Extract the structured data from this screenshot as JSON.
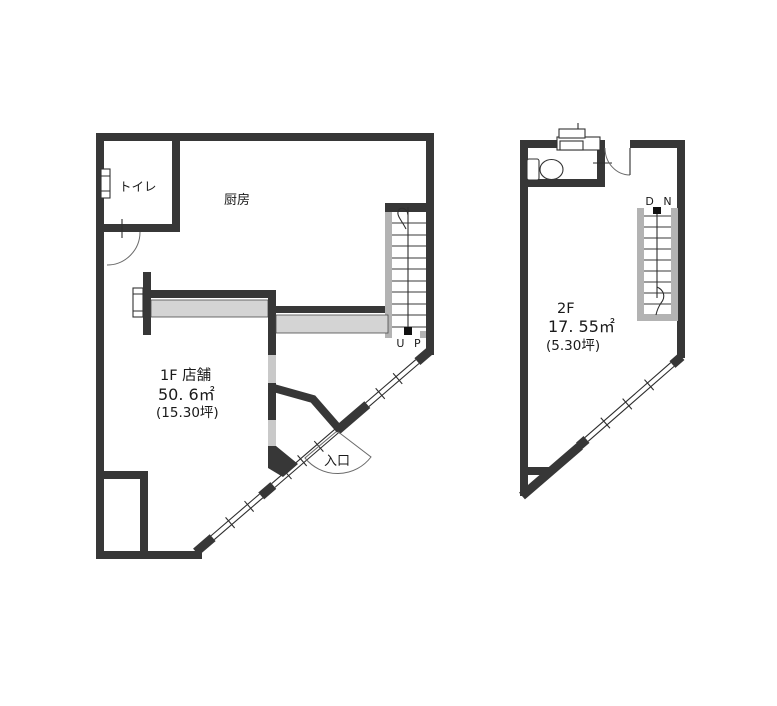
{
  "document_type": "floor-plan",
  "colors": {
    "wall": "#373737",
    "stair_band": "#b3b3b3",
    "counter_fill": "#d4d4d4",
    "opening_fill": "#c9c9c9",
    "background": "#ffffff",
    "text": "#1a1a1a"
  },
  "floor1": {
    "title": "1F 店舗",
    "area_m2": "50. 6㎡",
    "area_tsubo": "(15.30坪)",
    "kitchen": "厨房",
    "toilet": "トイレ",
    "entrance": "入口",
    "stair": "U P"
  },
  "floor2": {
    "title": "2F",
    "area_m2": "17. 55㎡",
    "area_tsubo": "(5.30坪)",
    "stair": "D N"
  }
}
